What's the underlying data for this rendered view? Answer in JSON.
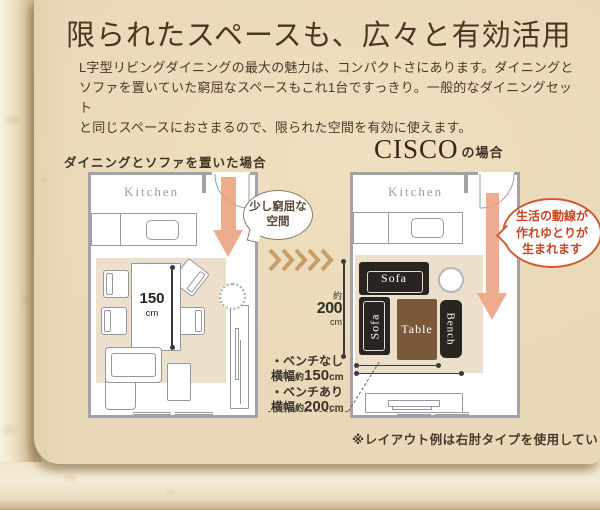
{
  "header": {
    "title": "限られたスペースも、広々と有効活用",
    "body_lines": [
      "L字型リビングダイニングの最大の魅力は、コンパクトさにあります。ダイニングと",
      "ソファを置いていた窮屈なスペースもこれ1台ですっきり。一般的なダイニングセット",
      "と同じスペースにおさまるので、限られた空間を有効に使えます。"
    ]
  },
  "left_plan": {
    "caption": "ダイニングとソファを置いた場合",
    "kitchen_label": "Kitchen",
    "table_width_value": "150",
    "table_width_unit": "cm",
    "bubble_lines": [
      "少し窮屈な",
      "空間"
    ]
  },
  "right_plan": {
    "brand": "CISCO",
    "caption_suffix": "の場合",
    "kitchen_label": "Kitchen",
    "sofa_top_label": "Sofa",
    "sofa_side_label": "Sofa",
    "table_label": "Table",
    "bench_label": "Bench",
    "bubble_lines": [
      "生活の動線が",
      "作れゆとりが",
      "生まれます"
    ],
    "depth_approx": "約",
    "depth_value": "200",
    "depth_unit": "cm"
  },
  "width_note": {
    "no_bench_label": "・ベンチなし",
    "no_bench_prefix": "横幅",
    "no_bench_approx": "約",
    "no_bench_value": "150",
    "no_bench_unit": "cm",
    "with_bench_label": "・ベンチあり",
    "with_bench_prefix": "横幅",
    "with_bench_approx": "約",
    "with_bench_value": "200",
    "with_bench_unit": "cm"
  },
  "footnote": "※レイアウト例は右肘タイプを使用しています。",
  "colors": {
    "paper": "#e9d9b8",
    "accent_arrow": "#ec9e7c",
    "bubble_orange": "#cf5a33",
    "furniture_dark": "#29241f",
    "table_brown": "#7a593a",
    "rug_beige": "#ece0cd",
    "chevron_tan": "#c79e6a",
    "plan_wall_gray": "#a3a2a8"
  }
}
